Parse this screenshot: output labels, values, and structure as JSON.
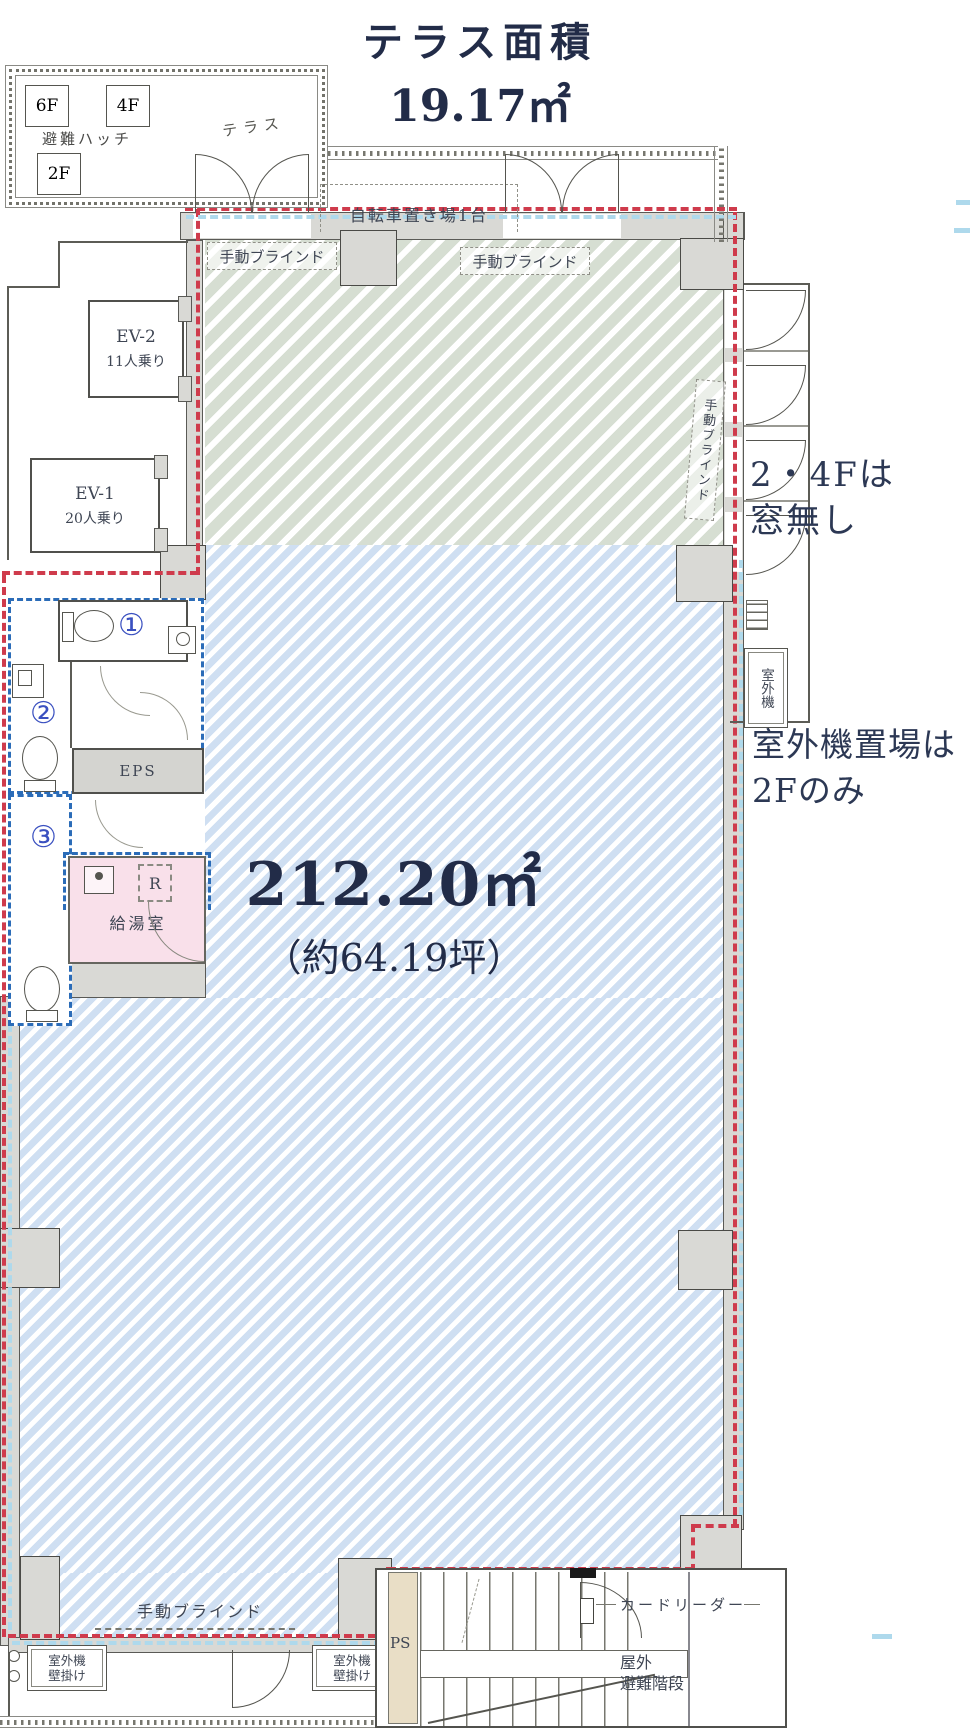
{
  "title": {
    "line1": "テラス面積",
    "line2": "19.17㎡"
  },
  "terrace": {
    "f6": "6F",
    "f4": "4F",
    "f2": "2F",
    "hatch_label": "避難ハッチ",
    "name": "テラス",
    "bicycle": "自転車置き場1台"
  },
  "blinds": {
    "manual": "手動ブラインド"
  },
  "elevators": {
    "ev2_name": "EV-2",
    "ev2_cap": "11人乗り",
    "ev1_name": "EV-1",
    "ev1_cap": "20人乗り"
  },
  "wc": {
    "n1": "①",
    "n2": "②",
    "n3": "③",
    "eps": "EPS"
  },
  "kitchen": {
    "name": "給湯室",
    "fridge": "R"
  },
  "area": {
    "sqm": "212.20㎡",
    "tsubo": "（約64.19坪）"
  },
  "notes": {
    "no_window_1": "2・4Fは",
    "no_window_2": "窓無し",
    "outdoor_unit": "室外機",
    "outdoor_place_1": "室外機置場は",
    "outdoor_place_2": "2Fのみ"
  },
  "bottom": {
    "unit_wall_1": "室外機",
    "unit_wall_2": "壁掛け",
    "ps": "PS",
    "card_reader": "カードリーダー",
    "stairs_1": "屋外",
    "stairs_2": "避難階段"
  },
  "colors": {
    "red_boundary": "#cf3b4c",
    "blue_boundary": "#2b6cb8",
    "window_blue": "#aed9ec",
    "hatch_blue": "#cfdff2",
    "hatch_green": "#d6ded2",
    "pink_room": "#f9e0ea",
    "wall_grey": "#d9d9d5",
    "text_navy": "#222c48",
    "circled_blue": "#3a50c0",
    "ps_beige": "#e9dec6"
  }
}
